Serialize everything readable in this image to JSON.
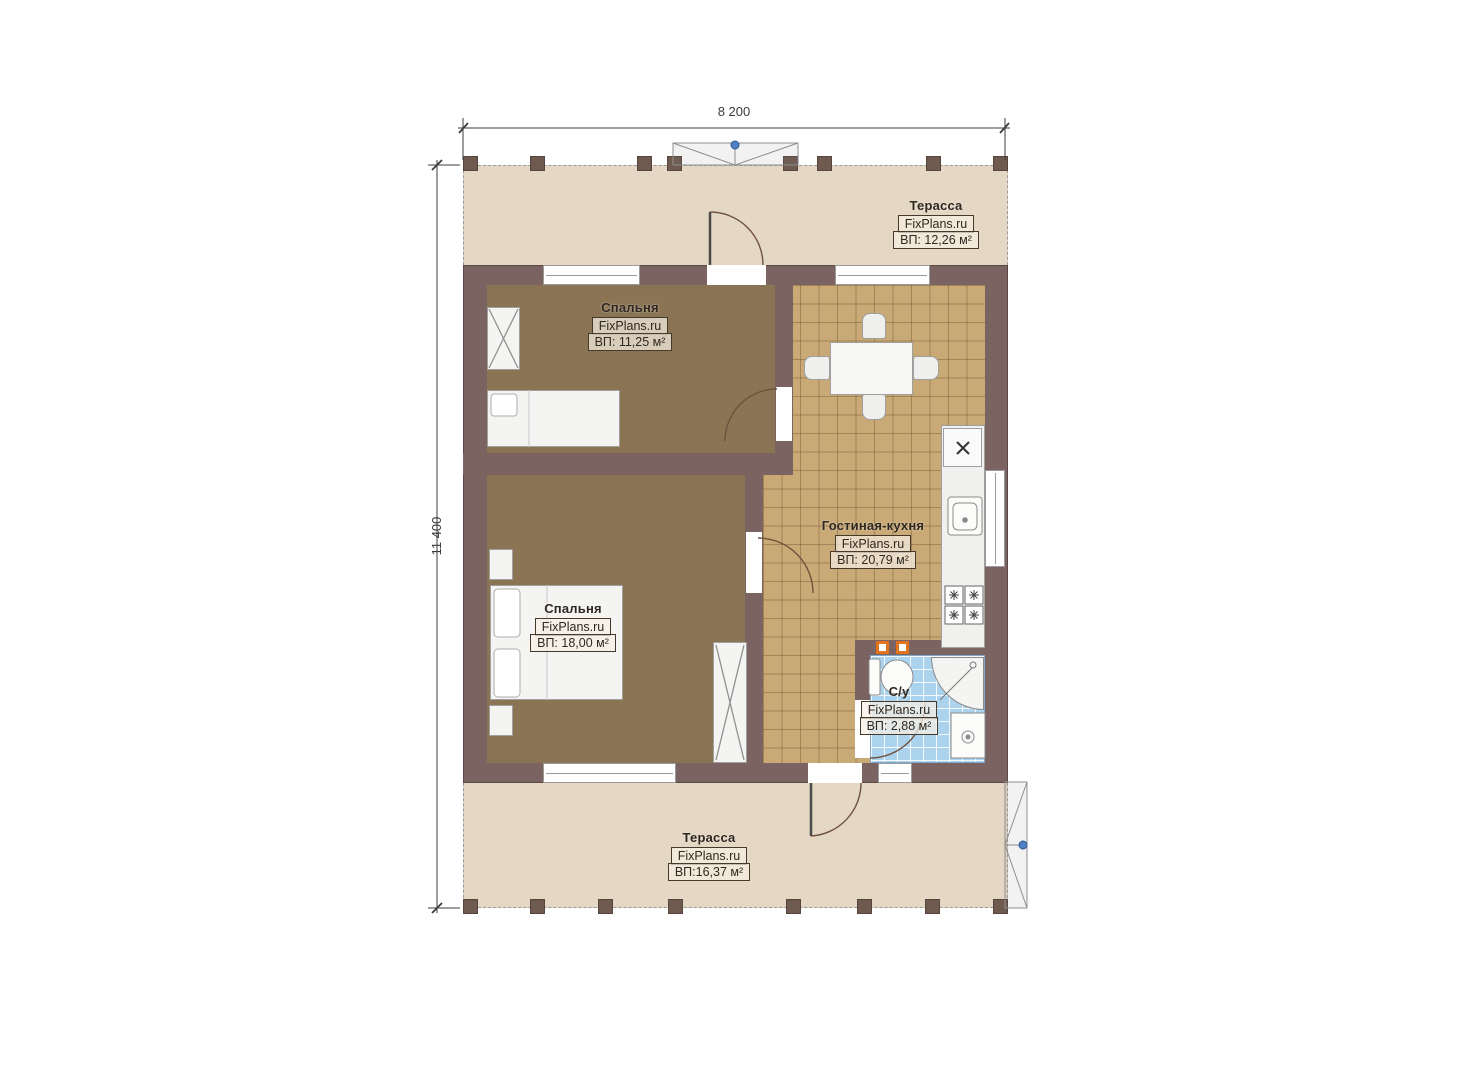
{
  "dimensions": {
    "width": "8 200",
    "height": "11 400"
  },
  "rooms": {
    "terrace_top": {
      "name": "Терасса",
      "watermark": "FixPlans.ru",
      "area": "ВП: 12,26 м²"
    },
    "bedroom_top": {
      "name": "Спальня",
      "watermark": "FixPlans.ru",
      "area": "ВП: 11,25 м²"
    },
    "living_kitchen": {
      "name": "Гостиная-кухня",
      "watermark": "FixPlans.ru",
      "area": "ВП: 20,79 м²"
    },
    "bedroom_bottom": {
      "name": "Спальня",
      "watermark": "FixPlans.ru",
      "area": "ВП: 18,00 м²"
    },
    "bathroom": {
      "name": "С/у",
      "watermark": "FixPlans.ru",
      "area": "ВП: 2,88 м²"
    },
    "terrace_bottom": {
      "name": "Терасса",
      "watermark": "FixPlans.ru",
      "area": "ВП:16,37 м²"
    }
  },
  "colors": {
    "wall": "#7a6360",
    "bedroom_floor": "#8b7454",
    "tile_floor": "#c9a976",
    "terrace_floor": "#e4d7c3",
    "bathroom_floor": "#abd3ee",
    "accent_orange": "#e2731e",
    "accent_blue": "#4f81c6"
  }
}
